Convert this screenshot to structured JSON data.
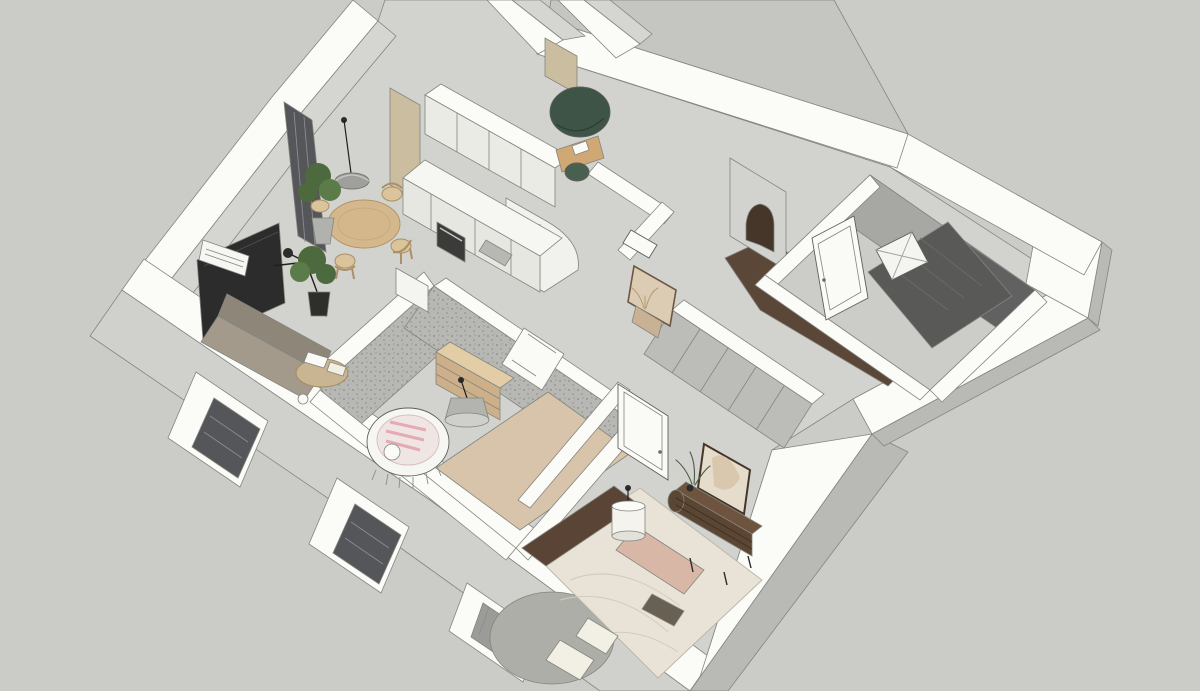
{
  "meta": {
    "view": "3d-isometric-cutaway-floor-plan",
    "render_style": "sketchup",
    "visible_text": ""
  },
  "colors": {
    "background": "#cbccc7",
    "slab": "#c5c6c1",
    "wallTop": "#fbfbf8",
    "faceLight": "#d5d6d1",
    "faceMed": "#b9bab5",
    "faceOuter": "#d0d1cc",
    "floorBase": "#d2d3ce",
    "floorLight": "#cccdc8",
    "terrazzo": "#b7b8b3",
    "terrazzoDot": "#8a8b86",
    "walnutFloor": "#5a4738",
    "archDark": "#46362a",
    "tileDark": "#595a58",
    "tileWall": "#606160",
    "bathWall": "#a7a8a3",
    "windowGlass": "#55565a",
    "tvBlack": "#2b2c2b",
    "white": "#f6f6f3",
    "cabinet": "#e7e7e2",
    "cabinetLight": "#ebebe6",
    "cabinetWhite": "#f1f1ed",
    "counterWhite": "#f6f6f2",
    "ovenDark": "#3b3b39",
    "steel": "#b7b8b3",
    "tanWall": "#cbbda0",
    "woodTable": "#d4b88c",
    "woodChair": "#dbc49b",
    "woodDesk": "#cfa873",
    "woodDresser": "#cdb089",
    "woodDresserTop": "#e2cda6",
    "walnutDresser": "#5b4533",
    "walnutDresserTop": "#6e543f",
    "headboard": "#5a4436",
    "bedding": "#e8e3d6",
    "pillow": "#f2efe5",
    "pinkRunner": "#d8b7a7",
    "trayDark": "#686052",
    "rugBeige": "#d8c4aa",
    "rugGray": "#aeaea8",
    "sofaBack": "#8e8678",
    "sofaSeat": "#a39a8b",
    "tableRound": "#c9b591",
    "greenPod": "#3e5447",
    "greenChair": "#49604f",
    "plantGreen": "#4c6a3e",
    "plantGreenLight": "#5b7c49",
    "potDark": "#2e2f2d",
    "potGray": "#b1b2ad",
    "lampShade": "#9fa09b",
    "lampCone": "#b3b4af",
    "coneBottom": "#cfd0cb",
    "cylShade": "#f4f3ee",
    "mirrorFill": "#e5dccb",
    "mirrorArt": "#d9c8ae",
    "mirrorHall": "#dcccb4",
    "consoleWood": "#c9b193",
    "wardrobe": "#bcbdb8",
    "doorWhite": "#fafaf7",
    "tub": "#f4f4f0",
    "radiator": "#9b9c97"
  },
  "scene": {
    "rooms": [
      {
        "name": "living-dining-room",
        "position": "upper-left",
        "furniture": [
          "tv-panel",
          "ac-unit",
          "sofa",
          "floor-lamp",
          "coffee-table",
          "round-dining-table",
          "dining-chairs",
          "pendant-lamp",
          "potted-plants",
          "window-wall"
        ]
      },
      {
        "name": "kitchen",
        "position": "top-center",
        "furniture": [
          "upper-cabinets",
          "counter-run",
          "built-in-oven",
          "sink",
          "rounded-tall-cabinet",
          "tan-accent-wall"
        ]
      },
      {
        "name": "office-nook",
        "position": "top-center-rear",
        "furniture": [
          "green-pod-chair",
          "desk",
          "desk-chair",
          "papers"
        ]
      },
      {
        "name": "entry-hall",
        "position": "top-right",
        "furniture": [
          "arched-opening",
          "walnut-floor",
          "wc-fixture"
        ]
      },
      {
        "name": "bathroom",
        "position": "right",
        "furniture": [
          "dark-mosaic-shower-floor",
          "dark-tile-wall",
          "bathtub",
          "bathroom-door"
        ]
      },
      {
        "name": "hallway",
        "position": "center",
        "furniture": [
          "sliding-wardrobe",
          "wall-mirror",
          "console-with-dried-plant"
        ]
      },
      {
        "name": "nursery",
        "position": "center-left",
        "furniture": [
          "terrazzo-walls",
          "oval-crib",
          "chest-of-drawers",
          "cone-pendant-lamp",
          "beige-rug",
          "door"
        ]
      },
      {
        "name": "bedroom",
        "position": "bottom-center",
        "furniture": [
          "bed-with-headboard",
          "pink-runner",
          "pillows",
          "round-gray-rug",
          "cylinder-pendant-lamp",
          "walnut-sideboard",
          "framed-mirror",
          "plant",
          "door",
          "wardrobe-panels"
        ]
      }
    ],
    "exterior": [
      "thick-white-cut-walls",
      "recessed-windows-with-blinds",
      "radiator-in-window",
      "right-wall-protrusion"
    ]
  }
}
